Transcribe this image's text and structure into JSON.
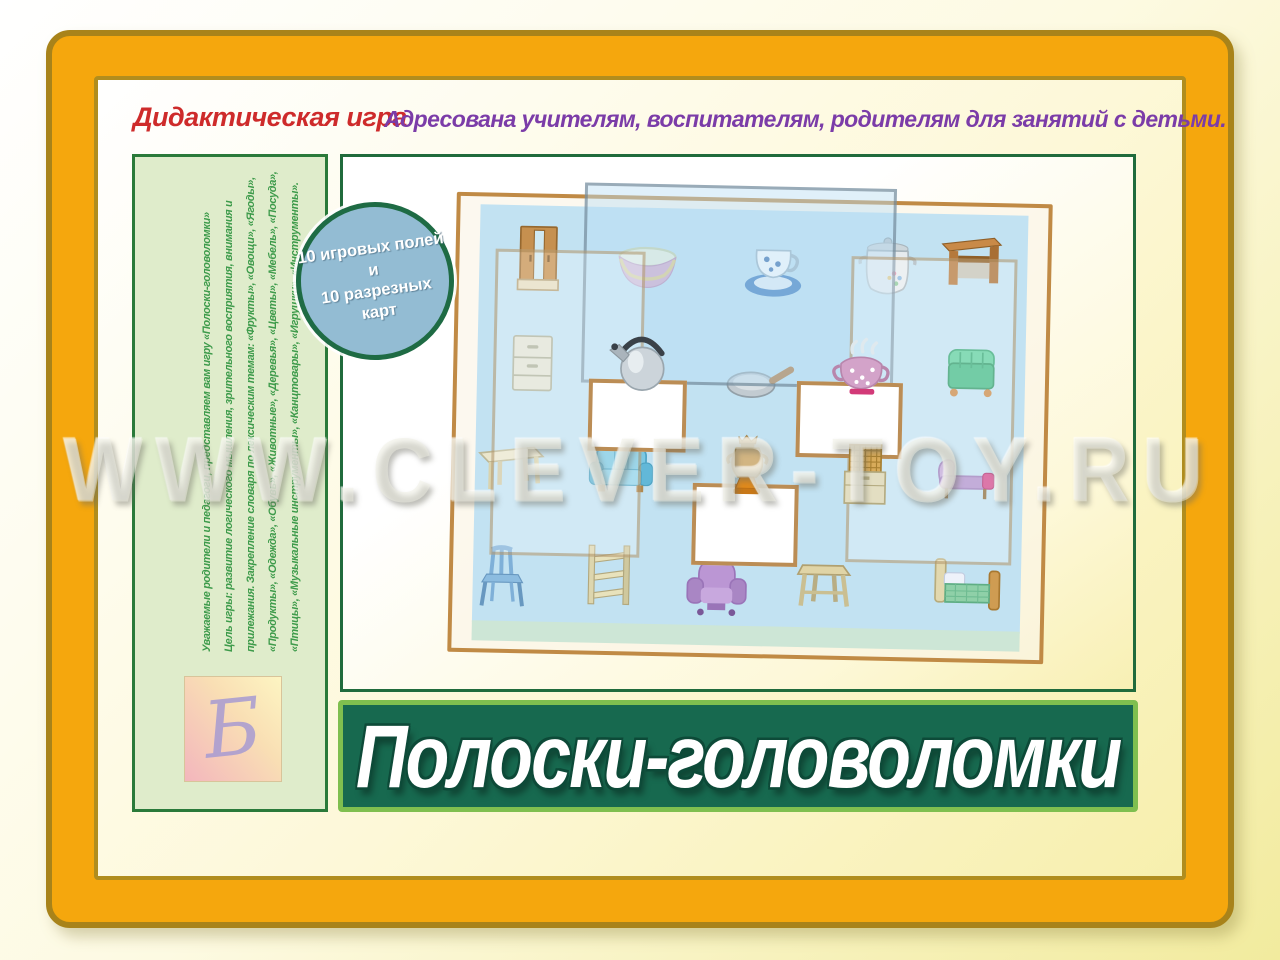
{
  "header": {
    "label": "Дидактическая игра",
    "audience": "Адресована учителям, воспитателям, родителям для занятий с детьми."
  },
  "badge": {
    "line1": "10 игровых полей и",
    "line2": "10 разрезных карт"
  },
  "sidebar": {
    "lines": [
      "Уважаемые родители и педагоги, представляем вам игру «Полоски-головоломки»",
      "Цель игры: развитие логического мышления, зрительного восприятия, внимания и",
      "прилежания. Закрепление словаря по лексическим темам: «Фрукты», «Овощи», «Ягоды»,",
      "«Продукты», «Одежда», «Обувь», «Животные», «Деревья», «Цветы», «Мебель», «Посуда»,",
      "«Птицы», «Музыкальные инструменты», «Канцтовары», «Игрушки», «Инструменты»."
    ],
    "logo_letter": "Б"
  },
  "board": {
    "items": [
      {
        "name": "wardrobe"
      },
      {
        "name": "bowl"
      },
      {
        "name": "cup-and-saucer"
      },
      {
        "name": "pot"
      },
      {
        "name": "desk"
      },
      {
        "name": "chest-of-drawers"
      },
      {
        "name": "kettle"
      },
      {
        "name": "frying-pan"
      },
      {
        "name": "teapot"
      },
      {
        "name": "pouf"
      },
      {
        "name": "table"
      },
      {
        "name": "sofa"
      },
      {
        "name": "samovar"
      },
      {
        "name": "cabinet"
      },
      {
        "name": "chaise-lounge"
      },
      {
        "name": "chair"
      },
      {
        "name": "shelf"
      },
      {
        "name": "armchair"
      },
      {
        "name": "stool"
      },
      {
        "name": "bed"
      }
    ]
  },
  "title": {
    "text": "Полоски-головоломки"
  },
  "watermark": {
    "text": "WWW.CLEVER-TOY.RU"
  },
  "colors": {
    "frame_orange": "#f5a70d",
    "frame_gold": "#a8831a",
    "banner_green": "#17694f",
    "banner_border": "#7fbf4f",
    "panel_border_green": "#206b3c",
    "sidebar_bg": "#dfeccb",
    "sidebar_text": "#3e9b4b",
    "header_red": "#ce2b2b",
    "header_purple": "#7b3ca8",
    "badge_blue": "#93bcd3",
    "board_blue": "#c2e2f2",
    "board_frame_tan": "#c08a45"
  }
}
